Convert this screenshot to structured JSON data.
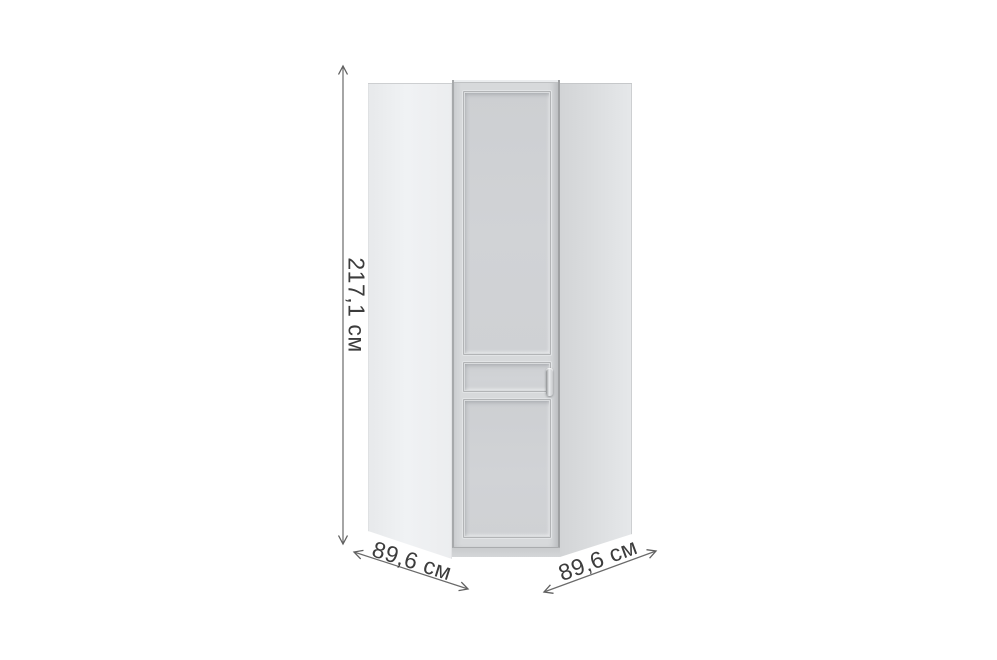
{
  "product": {
    "type_name": "corner-wardrobe-with-door",
    "view": "front-product-render"
  },
  "dimensions": {
    "height": "217,1 см",
    "width_left": "89,6 см",
    "width_right": "89,6 см"
  },
  "annotation": {
    "line_color": "#606060",
    "text_color": "#3c3c3c"
  },
  "colors": {
    "background": "#ffffff",
    "left_panel": "#eef0f2",
    "right_panel": "#dcdee0",
    "door_face": "#d7d9db",
    "door_panel_field": "#d0d2d5"
  }
}
